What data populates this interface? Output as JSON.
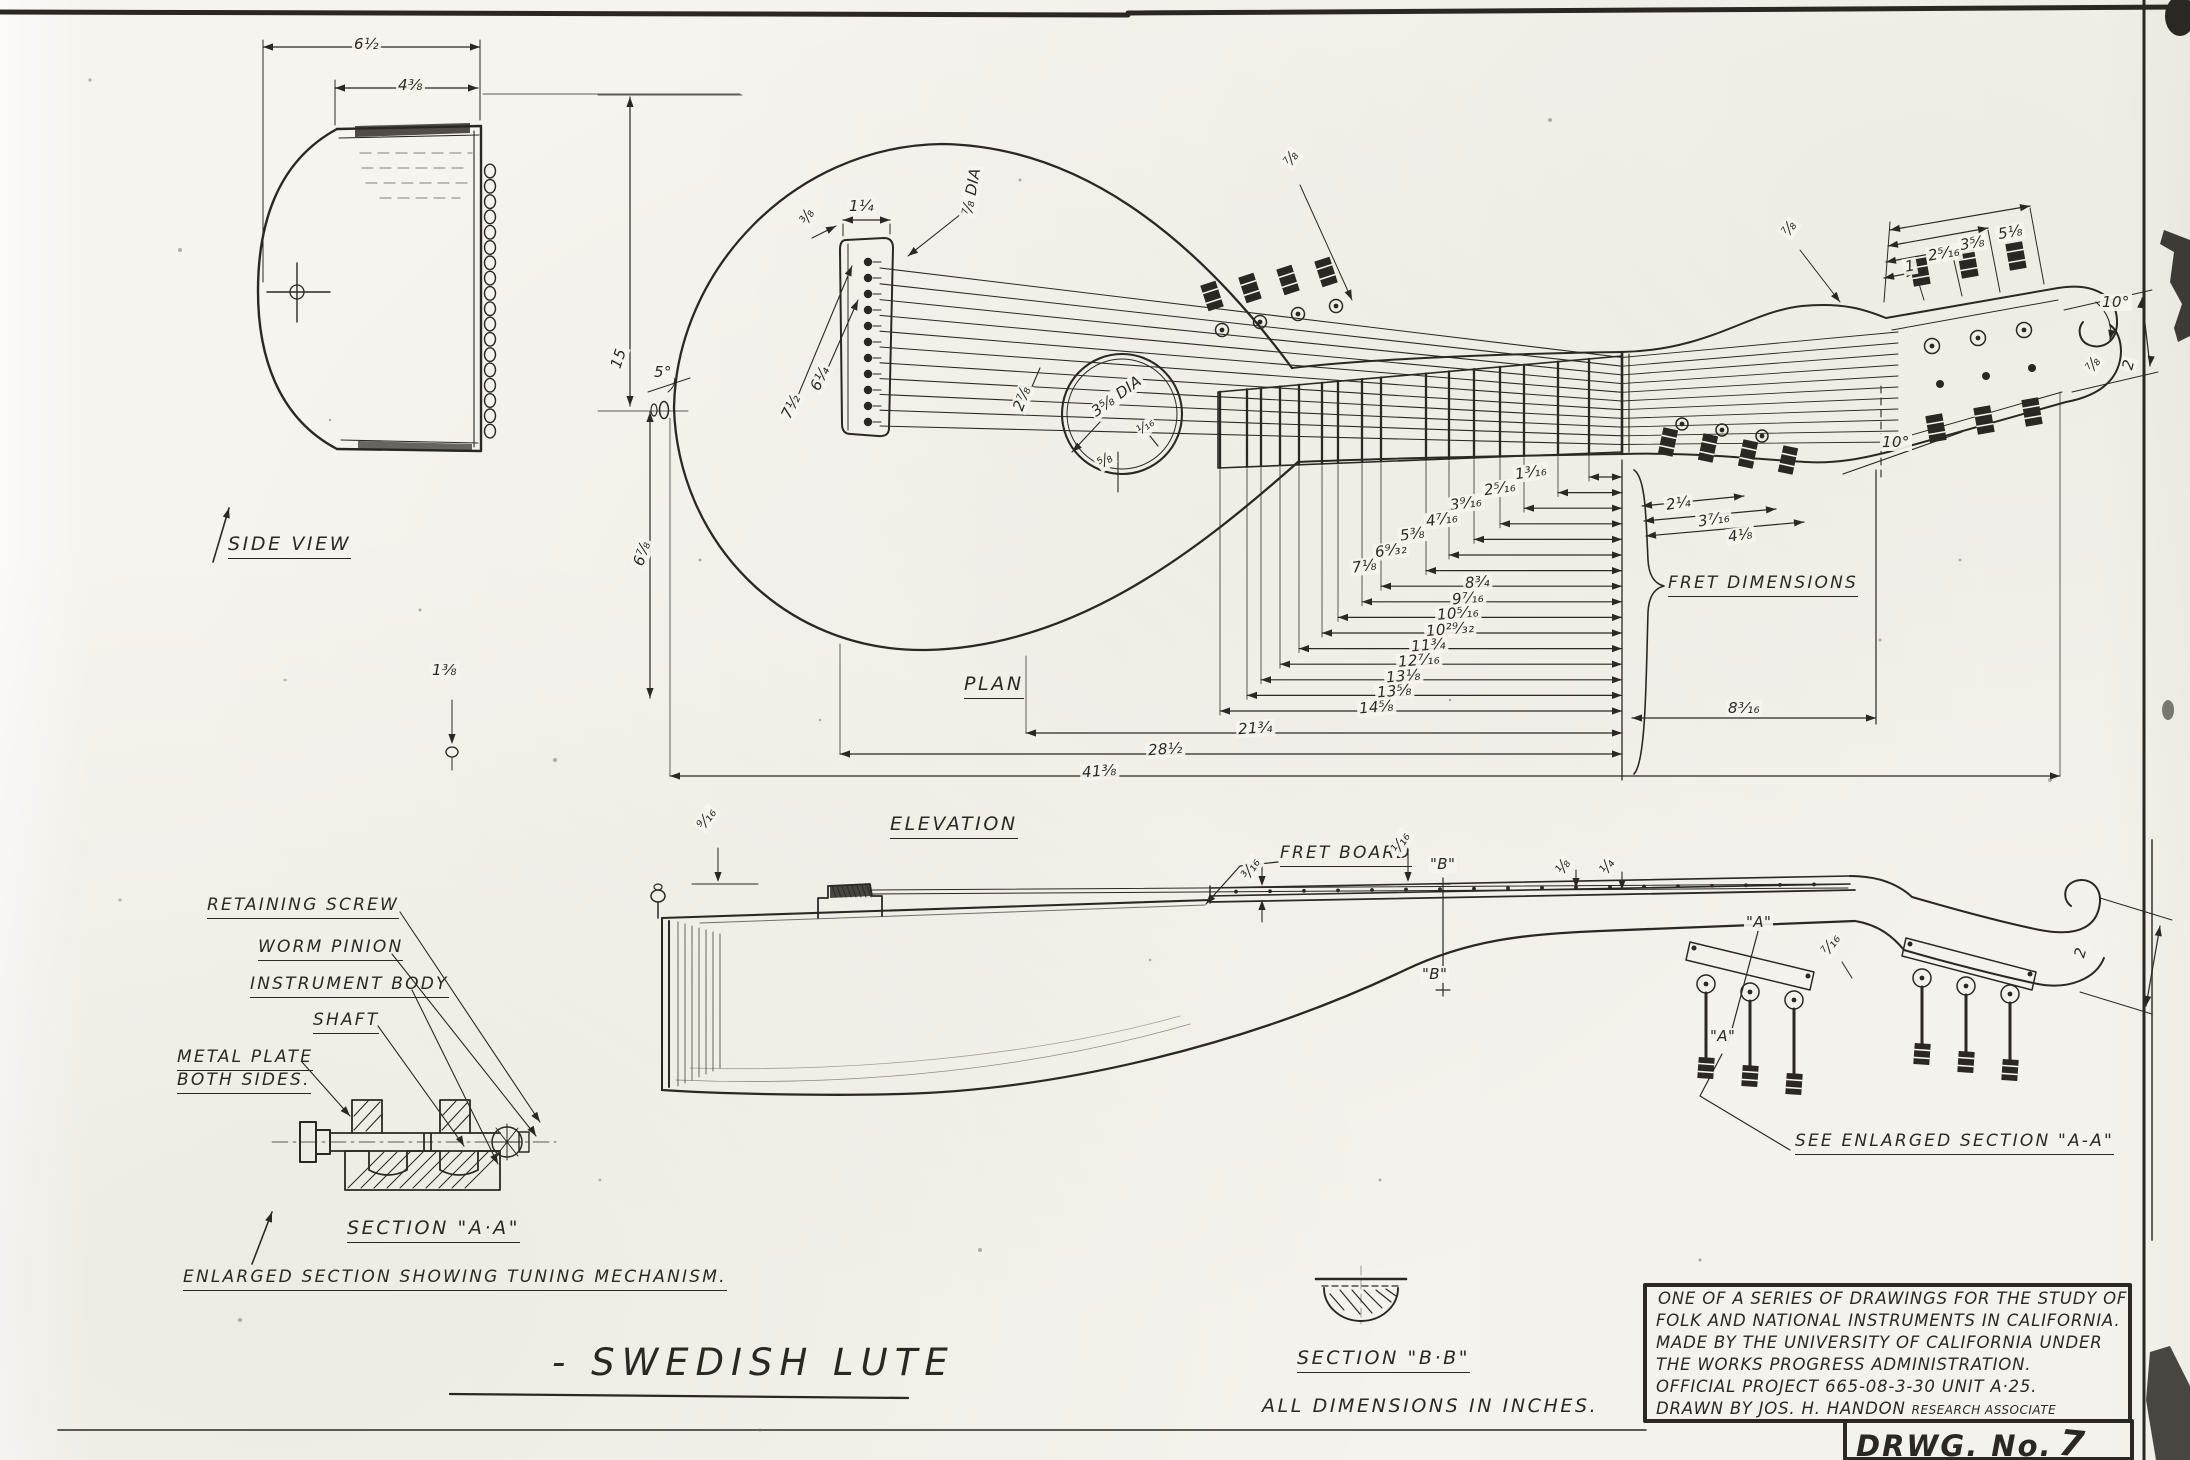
{
  "colors": {
    "ink": "#2b2823",
    "paper": "#f5f3ed"
  },
  "title": {
    "text": "- SWEDISH  LUTE"
  },
  "footer": {
    "all_dims": "ALL DIMENSIONS IN INCHES.",
    "drwg_label": "DRWG. No.",
    "drwg_number": "7"
  },
  "title_block": {
    "lines": [
      "ONE OF A SERIES OF DRAWINGS FOR THE STUDY OF",
      "FOLK AND NATIONAL INSTRUMENTS IN CALIFORNIA.",
      "MADE BY THE UNIVERSITY OF CALIFORNIA UNDER",
      "THE WORKS PROGRESS ADMINISTRATION.",
      "OFFICIAL PROJECT 665-08-3-30  UNIT A·25."
    ],
    "drawn_by": "DRAWN BY JOS. H. HANDON",
    "drawn_by_role": "RESEARCH ASSOCIATE"
  },
  "side_view": {
    "label": "SIDE VIEW",
    "dims": {
      "overall_width": "6½",
      "top_width": "4⅜"
    }
  },
  "plan_view": {
    "label": "PLAN",
    "dims": {
      "body_length": "15",
      "body_half": "6⅞",
      "bridge_width": "1¼",
      "bridge_inset": "⅜",
      "tail_long": "7½",
      "tail_short": "6¼",
      "bridge_angle": "5°",
      "string_dia": "⅞ DIA",
      "soundhole_dia": "3⅝ DIA",
      "soundhole_edge": "⅝",
      "string_height": "¹⁄₁₆",
      "waist": "2⅞",
      "neck_width": "⅞"
    },
    "headstock_dims": {
      "d1": "1",
      "d2": "2⁵⁄₁₆",
      "d3": "3⅝",
      "d4": "5⅛",
      "taper": "⅞",
      "angle": "10°",
      "tip_width": "⅞",
      "tip_depth": "2",
      "tilt": "10°"
    }
  },
  "fret_dimensions": {
    "label": "FRET DIMENSIONS",
    "values": [
      "1³⁄₁₆",
      "2⁵⁄₁₆",
      "3⁹⁄₁₆",
      "4⁷⁄₁₆",
      "5⅜",
      "6⁹⁄₃₂",
      "7⅛",
      "8¾",
      "9⁷⁄₁₆",
      "10⁵⁄₁₆",
      "10²⁹⁄₃₂",
      "11¾",
      "12⁷⁄₁₆",
      "13⅛",
      "13⅝",
      "14⅝"
    ],
    "overall": [
      "21¾",
      "28½",
      "41⅜"
    ],
    "pegbox": [
      "2¼",
      "3⁷⁄₁₆",
      "4⅛"
    ],
    "nut_to_end": "8³⁄₁₆"
  },
  "elevation_view": {
    "label": "ELEVATION",
    "fret_board_label": "FRET BOARD",
    "see_enlarged": "SEE ENLARGED SECTION \"A-A\"",
    "section_a_mark": "\"A\"",
    "section_b_mark": "\"B\"",
    "dims": {
      "bridge_height": "⁹⁄₁₆",
      "edge_height": "1⅜",
      "board_thickness": "³⁄₁₆",
      "string_clearance": "¹⁄₁₆",
      "nut_rise": "⅛",
      "nut_width": "¼",
      "heel": "⁷⁄₁₆",
      "head_depth": "2"
    }
  },
  "section_aa": {
    "label": "SECTION \"A·A\"",
    "caption": "ENLARGED SECTION SHOWING TUNING MECHANISM.",
    "callouts": {
      "c1": "RETAINING SCREW",
      "c2": "WORM PINION",
      "c3": "INSTRUMENT BODY",
      "c4": "SHAFT",
      "c5": "METAL PLATE",
      "c6": "BOTH SIDES."
    }
  },
  "section_bb": {
    "label": "SECTION \"B·B\""
  }
}
